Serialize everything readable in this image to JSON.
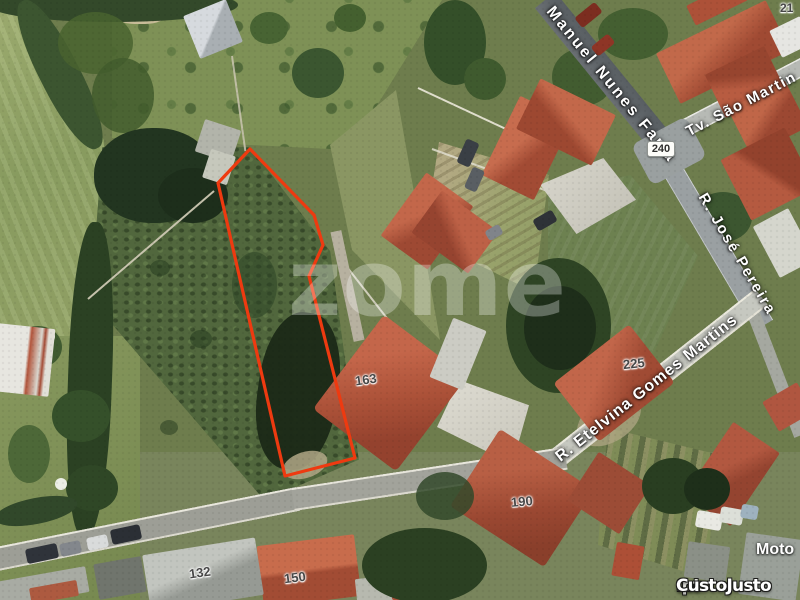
{
  "streets": {
    "manuel_nunes_faria": "Manuel Nunes Faria",
    "tv_sao_martin": "Tv. São Martin",
    "r_jose_pereira": "R. José Pereira",
    "r_etelvina_gomes_martins": "R. Etelvina Gomes Martins"
  },
  "road_numbers": {
    "badge_240": "240"
  },
  "house_numbers": {
    "n21": "21",
    "n132": "132",
    "n150": "150",
    "n163": "163",
    "n190": "190",
    "n225": "225"
  },
  "labels": {
    "moto": "Moto"
  },
  "watermark": {
    "text": "zome"
  },
  "branding": {
    "name": "CustoJusto",
    "tld": ".pt"
  },
  "colors": {
    "plot_boundary": "#ee3a10"
  }
}
